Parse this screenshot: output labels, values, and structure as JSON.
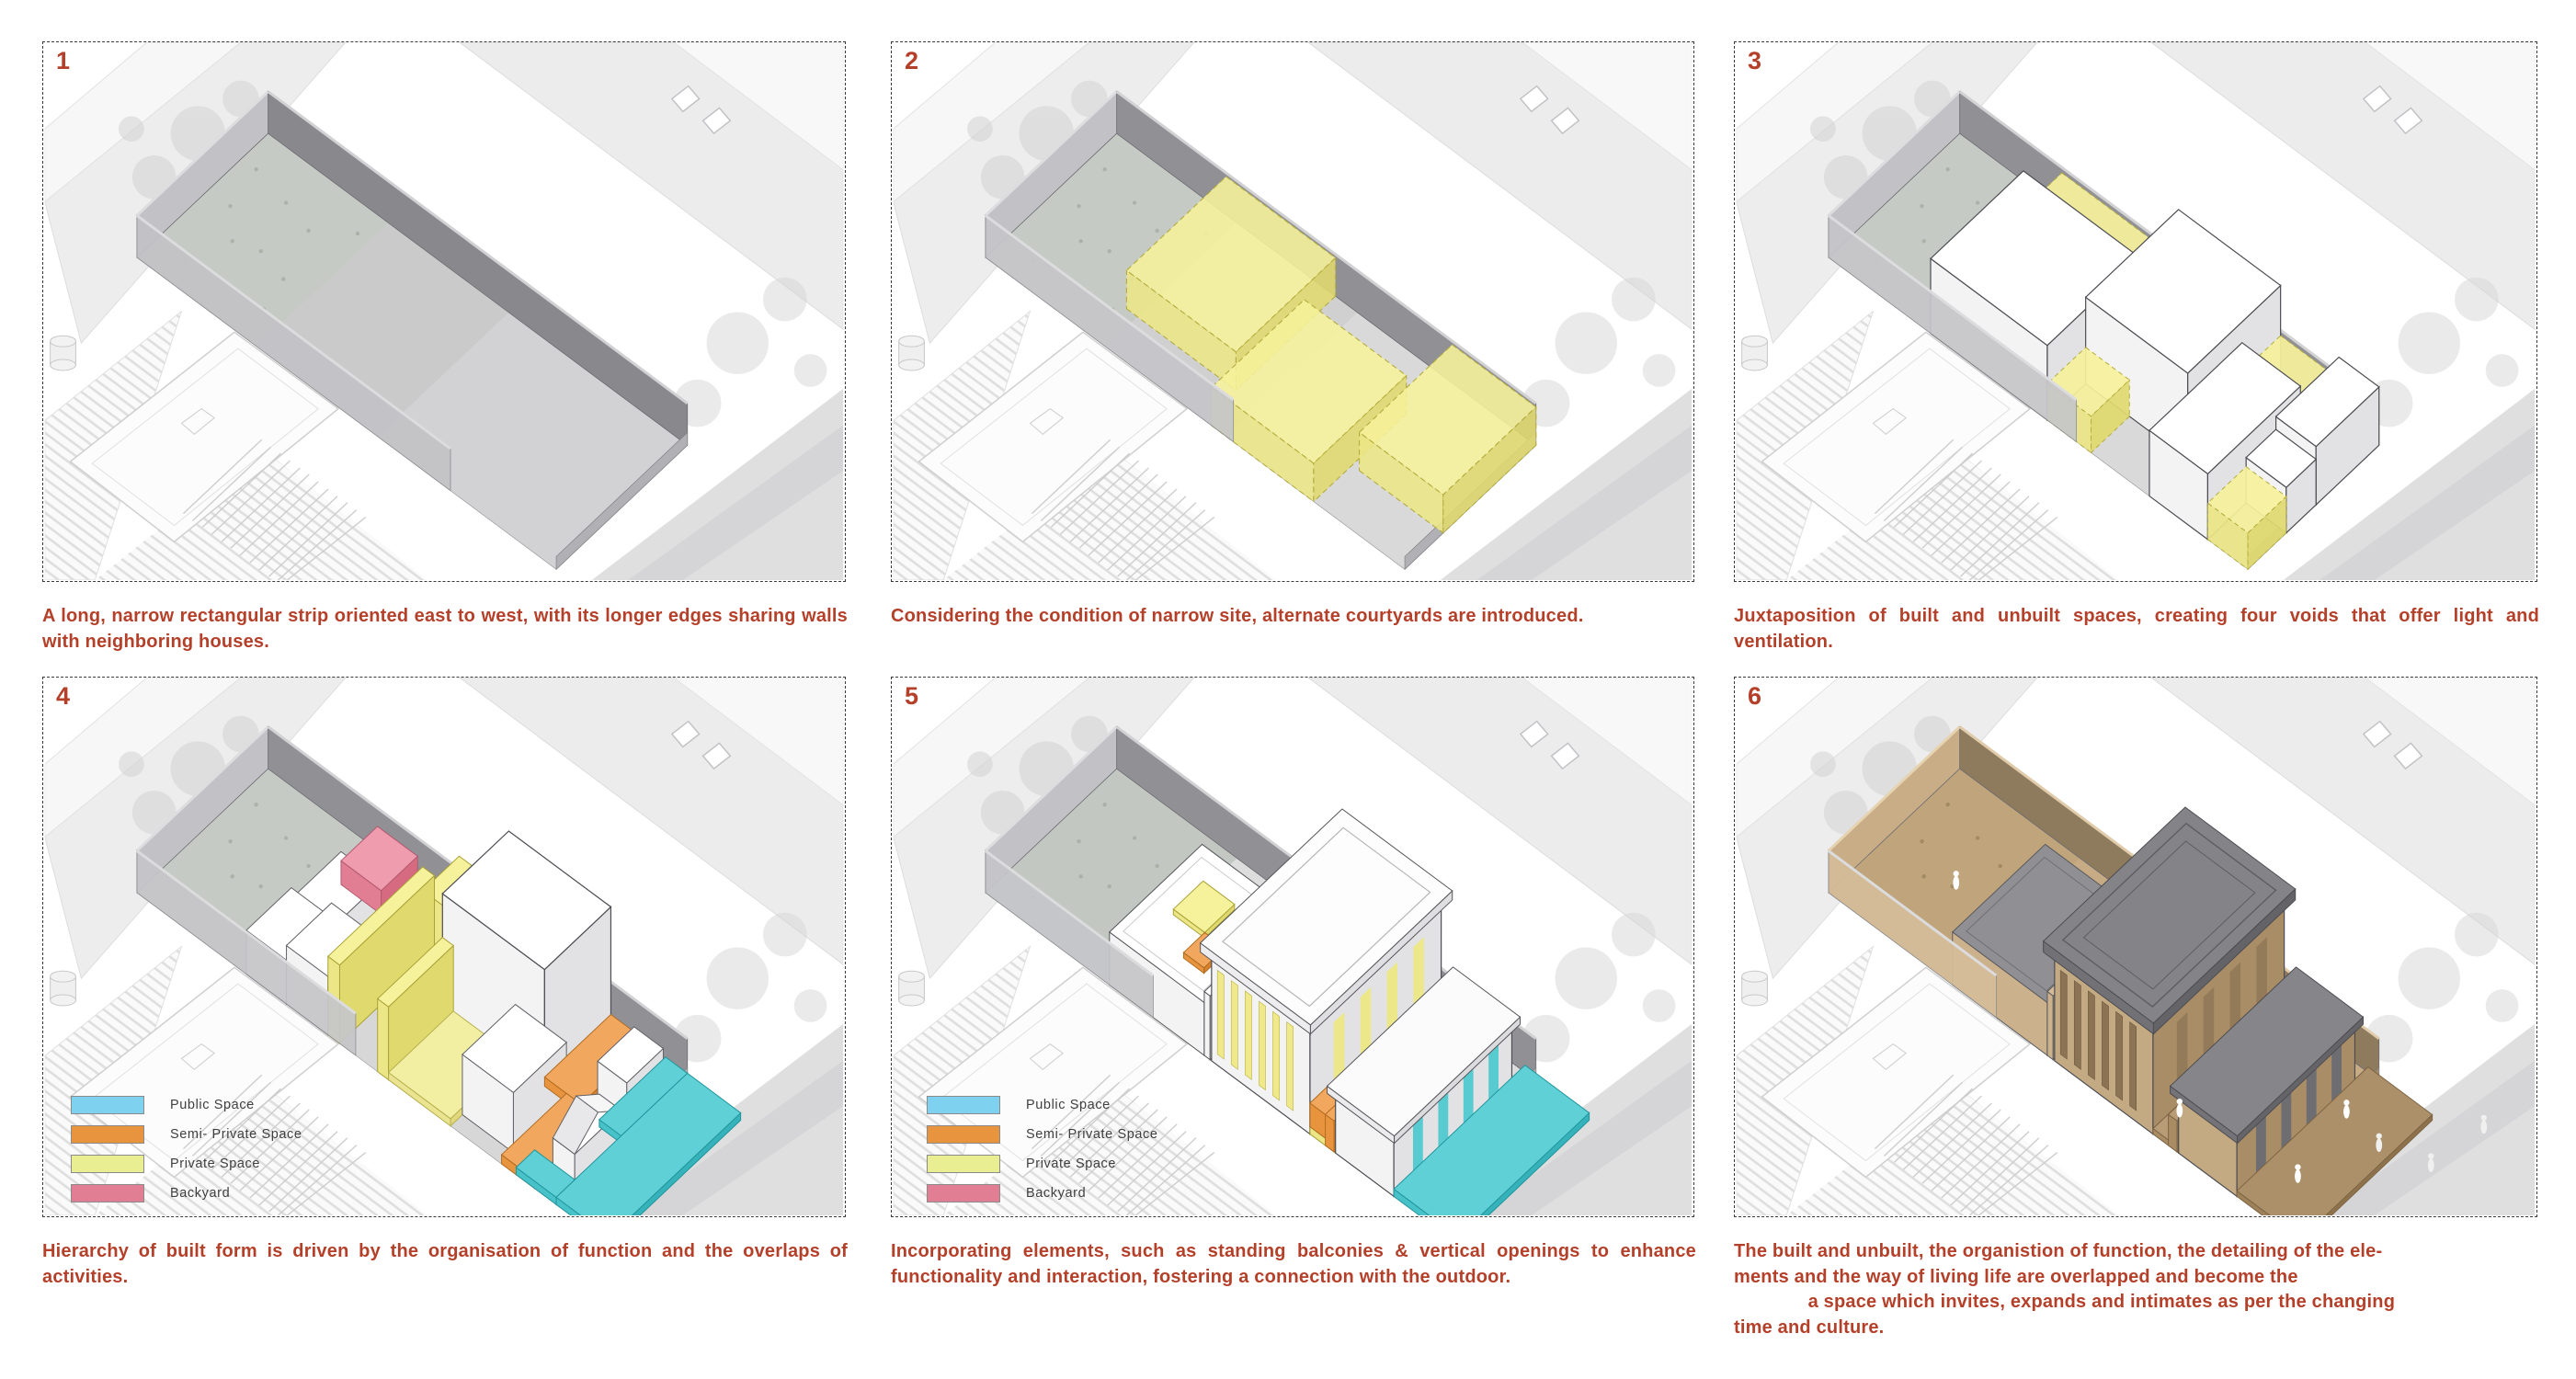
{
  "board": {
    "caption_color": "#b5402a",
    "panel_number_color": "#b5402a",
    "panels": [
      {
        "number": "1",
        "caption": "A long, narrow rectangular strip oriented east to west, with its longer edges sharing walls with neighboring houses."
      },
      {
        "number": "2",
        "caption": "Considering the condition of narrow site, alternate courtyards are introduced."
      },
      {
        "number": "3",
        "caption": "Juxtaposition of built and unbuilt spaces, creating four voids that offer light and ventilation."
      },
      {
        "number": "4",
        "caption": "Hierarchy of built form is driven by the organisation of function and the overlaps of activities."
      },
      {
        "number": "5",
        "caption": "Incorporating elements, such as standing balconies & vertical openings to enhance functionality and interaction, fostering a connection with the outdoor."
      },
      {
        "number": "6",
        "caption": "The built and unbuilt, the organistion of function, the detailing of the ele-\nments and the way of living life are overlapped and become the\n              a space which invites, expands and intimates as per the changing\ntime and culture."
      }
    ]
  },
  "legend": {
    "items": [
      {
        "label": "Public Space",
        "color": "#7ed2f0"
      },
      {
        "label": "Semi- Private Space",
        "color": "#e8943e"
      },
      {
        "label": "Private Space",
        "color": "#eaee92"
      },
      {
        "label": "Backyard",
        "color": "#e27e93"
      }
    ]
  },
  "diagram_colors": {
    "courtyard_yellow": "#f3ee8f",
    "public_cyan": "#4fc8ce",
    "semi_private_orange": "#e8943e",
    "private_yellow": "#eaee92",
    "backyard_pink": "#e27e93",
    "site_floor_gray": "#d6d6d8",
    "wall_gray": "#909095",
    "render_tan": "#c9b18b",
    "render_roof_gray": "#85858a"
  }
}
